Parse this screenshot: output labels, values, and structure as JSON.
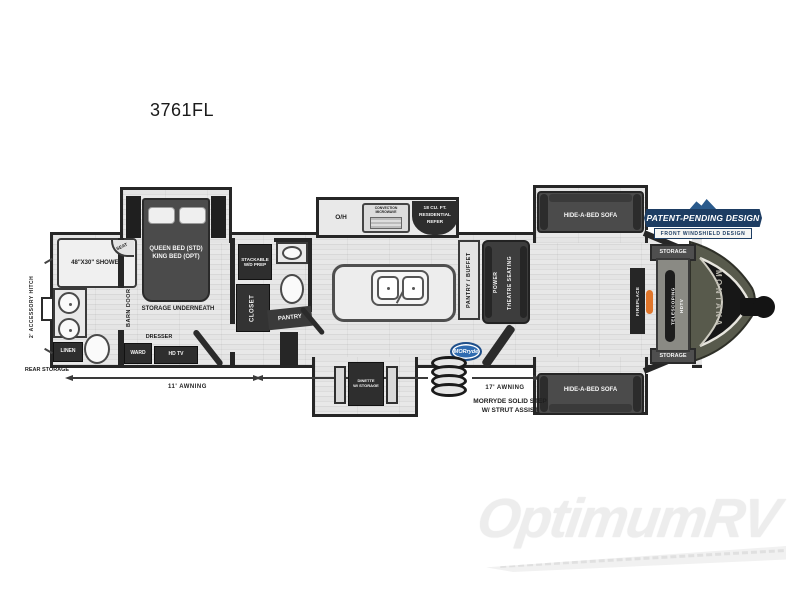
{
  "title": "3761FL",
  "watermark": {
    "brand": "OptimumRV"
  },
  "floorplan": {
    "exterior": {
      "accessory_hitch": "2' ACCESSORY HITCH",
      "rear_storage": "REAR STORAGE",
      "awning_left": "11' AWNING",
      "awning_right": "17' AWNING",
      "step_line1": "MORRYDE SOLID STEP",
      "step_line2": "W/ STRUT ASSIST",
      "morryde_logo": "MORryde"
    },
    "badge": {
      "line1": "PATENT-PENDING DESIGN",
      "line2": "FRONT WINDSHIELD DESIGN"
    },
    "bathroom": {
      "shower": "48\"X30\" SHOWER",
      "seat": "SEAT",
      "linen": "LINEN",
      "barn_door": "BARN DOOR"
    },
    "bedroom": {
      "bed_line1": "QUEEN BED (STD)",
      "bed_line2": "KING BED (OPT)",
      "storage_underneath": "STORAGE UNDERNEATH",
      "dresser": "DRESSER",
      "ward": "WARD",
      "tv": "HD TV"
    },
    "utility": {
      "washer": "STACKABLE W/D PREP",
      "closet": "CLOSET",
      "pantry": "PANTRY"
    },
    "kitchen": {
      "overhead": "O/H",
      "microwave": "CONVECTION MICROWAVE",
      "refer_line1": "18 CU. FT.",
      "refer_line2": "RESIDENTIAL",
      "refer_line3": "REFER",
      "pantry_buffet": "PANTRY / BUFFET"
    },
    "living": {
      "theatre_line1": "POWER",
      "theatre_line2": "THEATRE SEATING",
      "sofa_top": "HIDE-A-BED SOFA",
      "sofa_bottom": "HIDE-A-BED SOFA",
      "dinette_line1": "DINETTE",
      "dinette_line2": "W/ STORAGE"
    },
    "front": {
      "storage_top": "STORAGE",
      "storage_bottom": "STORAGE",
      "fireplace": "FIREPLACE",
      "tv_line1": "TELESCOPING",
      "tv_line2": "HDTV",
      "brand": "MONTANA"
    }
  },
  "colors": {
    "wall": "#262626",
    "furniture_dark": "#2e2e2e",
    "sofa_gray": "#4b4b4b",
    "cap_olive": "#585a4c",
    "badge_navy": "#1d3d63",
    "morryde_blue": "#2f6bb0",
    "flame_orange": "#e0762b",
    "watermark_gray": "#ededed"
  }
}
